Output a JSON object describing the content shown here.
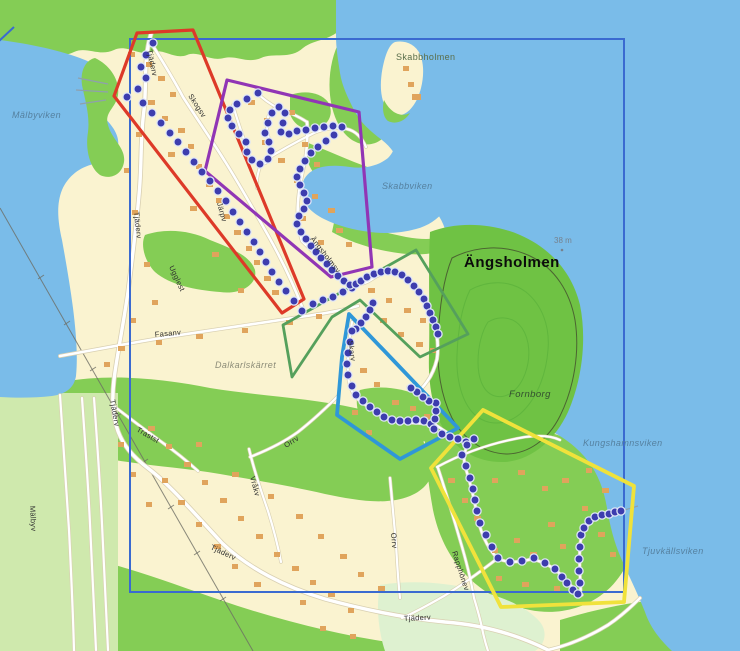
{
  "map_title": "Ängsholmen orienteering courses map",
  "colors": {
    "water": "#7abce9",
    "land": "#faf3d0",
    "forest": "#84cd55",
    "forest_dark": "#6fc244",
    "field_light": "#cfe9ad",
    "field_pale": "#def1d0",
    "building": "#e0a45c",
    "boundary_blue": "#3a6ad0",
    "course_red": "#dd3a28",
    "course_purple": "#9135b5",
    "course_green": "#55a05c",
    "course_blue": "#2f97d8",
    "course_yellow": "#f0e23b",
    "trail_dot": "#3d3dae"
  },
  "boundary": {
    "x": 130,
    "y": 39,
    "width": 494,
    "height": 553,
    "color": "#3a6ad0"
  },
  "courses": [
    {
      "id": "red",
      "color": "#dd3a28",
      "stroke_width": 3.2,
      "points": "137,33 193,30 304,299 282,313 114,96"
    },
    {
      "id": "purple",
      "color": "#9135b5",
      "stroke_width": 3.2,
      "points": "227,80 359,112 372,267 331,277 205,171"
    },
    {
      "id": "green",
      "color": "#55a05c",
      "stroke_width": 2.8,
      "points": "416,250 468,334 420,357 360,300 332,317 292,377 283,325"
    },
    {
      "id": "blue",
      "color": "#2f97d8",
      "stroke_width": 3.8,
      "points": "349,314 394,361 458,428 400,459 337,415 342,357"
    },
    {
      "id": "yellow",
      "color": "#f0e23b",
      "stroke_width": 3.8,
      "points": "483,410 634,486 624,602 501,607 431,468"
    }
  ],
  "trails": [
    {
      "id": "trail-red",
      "dots": [
        [
          153,
          43
        ],
        [
          146,
          55
        ],
        [
          141,
          67
        ],
        [
          146,
          78
        ],
        [
          138,
          89
        ],
        [
          127,
          97
        ],
        [
          143,
          103
        ],
        [
          152,
          113
        ],
        [
          161,
          123
        ],
        [
          170,
          133
        ],
        [
          178,
          142
        ],
        [
          186,
          152
        ],
        [
          194,
          162
        ],
        [
          202,
          172
        ],
        [
          210,
          181
        ],
        [
          218,
          191
        ],
        [
          226,
          201
        ],
        [
          233,
          212
        ],
        [
          240,
          222
        ],
        [
          247,
          232
        ],
        [
          254,
          242
        ],
        [
          260,
          252
        ],
        [
          266,
          262
        ],
        [
          272,
          272
        ],
        [
          279,
          282
        ],
        [
          286,
          291
        ],
        [
          294,
          301
        ],
        [
          302,
          311
        ],
        [
          313,
          304
        ],
        [
          323,
          300
        ],
        [
          333,
          297
        ],
        [
          343,
          292
        ],
        [
          352,
          288
        ]
      ]
    },
    {
      "id": "trail-purple",
      "dots": [
        [
          258,
          93
        ],
        [
          247,
          99
        ],
        [
          237,
          104
        ],
        [
          230,
          110
        ],
        [
          228,
          118
        ],
        [
          232,
          126
        ],
        [
          239,
          134
        ],
        [
          246,
          142
        ],
        [
          247,
          152
        ],
        [
          252,
          160
        ],
        [
          260,
          164
        ],
        [
          268,
          159
        ],
        [
          271,
          151
        ],
        [
          269,
          142
        ],
        [
          265,
          133
        ],
        [
          268,
          123
        ],
        [
          272,
          113
        ],
        [
          279,
          107
        ],
        [
          285,
          113
        ],
        [
          283,
          123
        ],
        [
          281,
          132
        ],
        [
          289,
          134
        ],
        [
          297,
          131
        ],
        [
          306,
          130
        ],
        [
          315,
          128
        ],
        [
          324,
          127
        ],
        [
          333,
          126
        ],
        [
          342,
          127
        ],
        [
          334,
          135
        ],
        [
          326,
          141
        ],
        [
          318,
          147
        ],
        [
          311,
          153
        ],
        [
          305,
          161
        ],
        [
          300,
          169
        ],
        [
          297,
          177
        ],
        [
          300,
          185
        ],
        [
          304,
          193
        ],
        [
          307,
          201
        ],
        [
          304,
          209
        ],
        [
          299,
          216
        ],
        [
          297,
          224
        ],
        [
          301,
          232
        ],
        [
          306,
          239
        ],
        [
          311,
          246
        ],
        [
          316,
          252
        ],
        [
          321,
          258
        ],
        [
          327,
          264
        ],
        [
          332,
          270
        ],
        [
          338,
          276
        ],
        [
          344,
          281
        ],
        [
          350,
          285
        ],
        [
          356,
          284
        ],
        [
          361,
          281
        ]
      ]
    },
    {
      "id": "trail-green",
      "dots": [
        [
          367,
          277
        ],
        [
          374,
          274
        ],
        [
          381,
          272
        ],
        [
          388,
          271
        ],
        [
          395,
          272
        ],
        [
          402,
          275
        ],
        [
          408,
          280
        ],
        [
          414,
          286
        ],
        [
          419,
          292
        ],
        [
          424,
          299
        ],
        [
          427,
          306
        ],
        [
          430,
          313
        ],
        [
          433,
          320
        ],
        [
          436,
          327
        ],
        [
          438,
          334
        ]
      ]
    },
    {
      "id": "trail-green-link",
      "dots": [
        [
          373,
          303
        ],
        [
          370,
          310
        ],
        [
          366,
          317
        ],
        [
          361,
          323
        ],
        [
          356,
          329
        ]
      ]
    },
    {
      "id": "trail-blue",
      "dots": [
        [
          352,
          331
        ],
        [
          350,
          342
        ],
        [
          348,
          353
        ],
        [
          347,
          364
        ],
        [
          348,
          375
        ],
        [
          352,
          386
        ],
        [
          356,
          395
        ],
        [
          363,
          401
        ],
        [
          370,
          407
        ],
        [
          377,
          412
        ],
        [
          384,
          417
        ],
        [
          392,
          420
        ],
        [
          400,
          421
        ],
        [
          408,
          421
        ],
        [
          416,
          420
        ],
        [
          424,
          421
        ],
        [
          431,
          424
        ],
        [
          435,
          419
        ],
        [
          436,
          411
        ],
        [
          436,
          403
        ],
        [
          429,
          401
        ],
        [
          423,
          397
        ],
        [
          417,
          392
        ],
        [
          411,
          388
        ]
      ]
    },
    {
      "id": "trail-blue-link",
      "dots": [
        [
          434,
          429
        ],
        [
          442,
          434
        ],
        [
          450,
          437
        ],
        [
          458,
          439
        ],
        [
          466,
          442
        ]
      ]
    },
    {
      "id": "trail-yellow",
      "dots": [
        [
          474,
          439
        ],
        [
          467,
          445
        ],
        [
          462,
          455
        ],
        [
          466,
          466
        ],
        [
          470,
          478
        ],
        [
          473,
          489
        ],
        [
          475,
          500
        ],
        [
          477,
          511
        ],
        [
          480,
          523
        ],
        [
          486,
          535
        ],
        [
          492,
          547
        ],
        [
          498,
          558
        ],
        [
          510,
          562
        ],
        [
          522,
          561
        ],
        [
          534,
          558
        ],
        [
          545,
          563
        ],
        [
          555,
          569
        ],
        [
          562,
          577
        ],
        [
          567,
          583
        ],
        [
          573,
          590
        ],
        [
          578,
          594
        ],
        [
          580,
          583
        ],
        [
          579,
          571
        ],
        [
          579,
          559
        ],
        [
          580,
          547
        ],
        [
          581,
          535
        ],
        [
          584,
          528
        ],
        [
          589,
          521
        ],
        [
          595,
          517
        ],
        [
          602,
          515
        ],
        [
          609,
          514
        ],
        [
          615,
          512
        ],
        [
          621,
          511
        ]
      ]
    }
  ],
  "labels": {
    "water": [
      {
        "id": "malbyviken",
        "text": "Mälbyviken"
      },
      {
        "id": "skabbviken",
        "text": "Skabbviken"
      },
      {
        "id": "kungshamnsviken",
        "text": "Kungshamnsviken"
      },
      {
        "id": "tjuvkallsviken",
        "text": "Tjuvkällsviken"
      }
    ],
    "places": [
      {
        "id": "skabbholmen",
        "text": "Skabbholmen"
      },
      {
        "id": "angsholmen",
        "text": "Ängsholmen"
      },
      {
        "id": "fornborg",
        "text": "Fornborg"
      },
      {
        "id": "dalkarlskarret",
        "text": "Dalkarlskärret"
      },
      {
        "id": "elevation-point",
        "text": "38 m"
      }
    ],
    "streets": [
      {
        "id": "tjaderv-top",
        "text": "Tjäderv"
      },
      {
        "id": "skogsv",
        "text": "Skogsv"
      },
      {
        "id": "jarpv",
        "text": "Järpv"
      },
      {
        "id": "tjaderv-mid",
        "text": "Tjäderv"
      },
      {
        "id": "ugglest",
        "text": "Ugglest"
      },
      {
        "id": "angsholmsv",
        "text": "Ängsholmsv"
      },
      {
        "id": "fasanv",
        "text": "Fasanv"
      },
      {
        "id": "skarv",
        "text": "Skarv"
      },
      {
        "id": "trastst",
        "text": "Trastst"
      },
      {
        "id": "tjaderv-left",
        "text": "Tjäderv"
      },
      {
        "id": "malbyv",
        "text": "Mälbyv"
      },
      {
        "id": "vrakv",
        "text": "Vråkv"
      },
      {
        "id": "orrv-upper",
        "text": "Orrv"
      },
      {
        "id": "orrv-lower",
        "text": "Orrv"
      },
      {
        "id": "tjaderv-diag",
        "text": "Tjäderv"
      },
      {
        "id": "tjaderv-bottom",
        "text": "Tjäderv"
      },
      {
        "id": "rapphonev",
        "text": "Rapphönev"
      }
    ]
  }
}
